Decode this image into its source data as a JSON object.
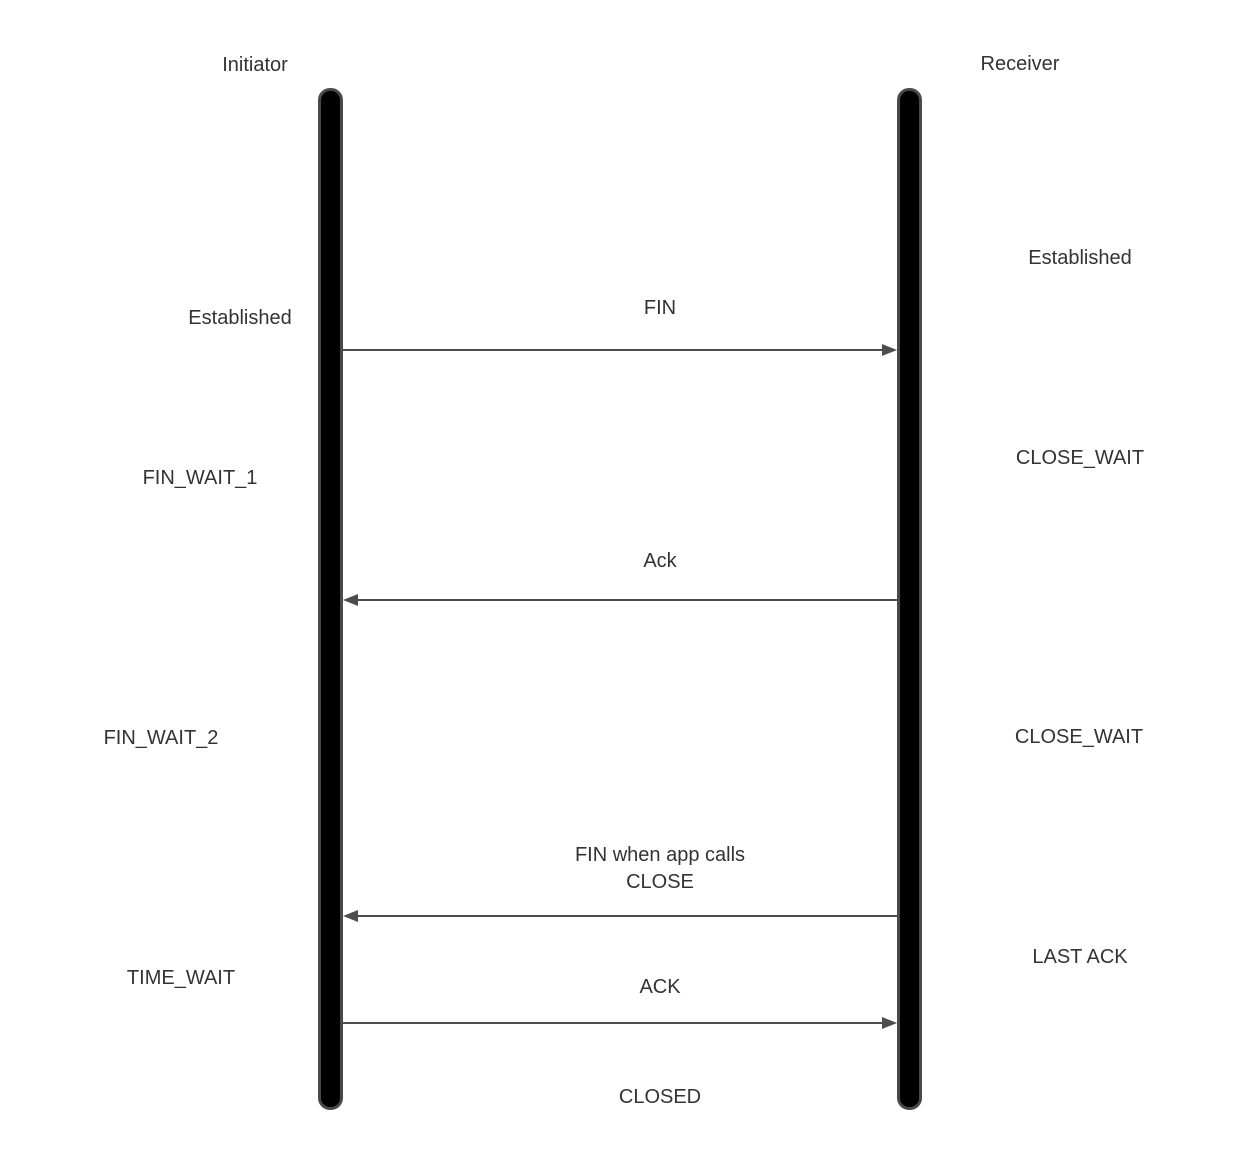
{
  "diagram": {
    "type": "sequence-diagram",
    "lifelines": {
      "initiator": {
        "label": "Initiator"
      },
      "receiver": {
        "label": "Receiver"
      }
    },
    "messages": [
      {
        "label": "FIN",
        "direction": "right",
        "from": "Initiator",
        "to": "Receiver"
      },
      {
        "label": "Ack",
        "direction": "left",
        "from": "Receiver",
        "to": "Initiator"
      },
      {
        "label_line1": "FIN when app calls",
        "label_line2": "CLOSE",
        "direction": "left",
        "from": "Receiver",
        "to": "Initiator"
      },
      {
        "label": "ACK",
        "direction": "right",
        "from": "Initiator",
        "to": "Receiver"
      }
    ],
    "states": {
      "initiator": [
        "Established",
        "FIN_WAIT_1",
        "FIN_WAIT_2",
        "TIME_WAIT"
      ],
      "receiver": [
        "Established",
        "CLOSE_WAIT",
        "CLOSE_WAIT",
        "LAST ACK"
      ],
      "final": "CLOSED"
    },
    "colors": {
      "arrow": "#4d4d4d",
      "bar_fill": "#000000",
      "bar_border": "#4a4a4a",
      "text": "#333333"
    }
  }
}
